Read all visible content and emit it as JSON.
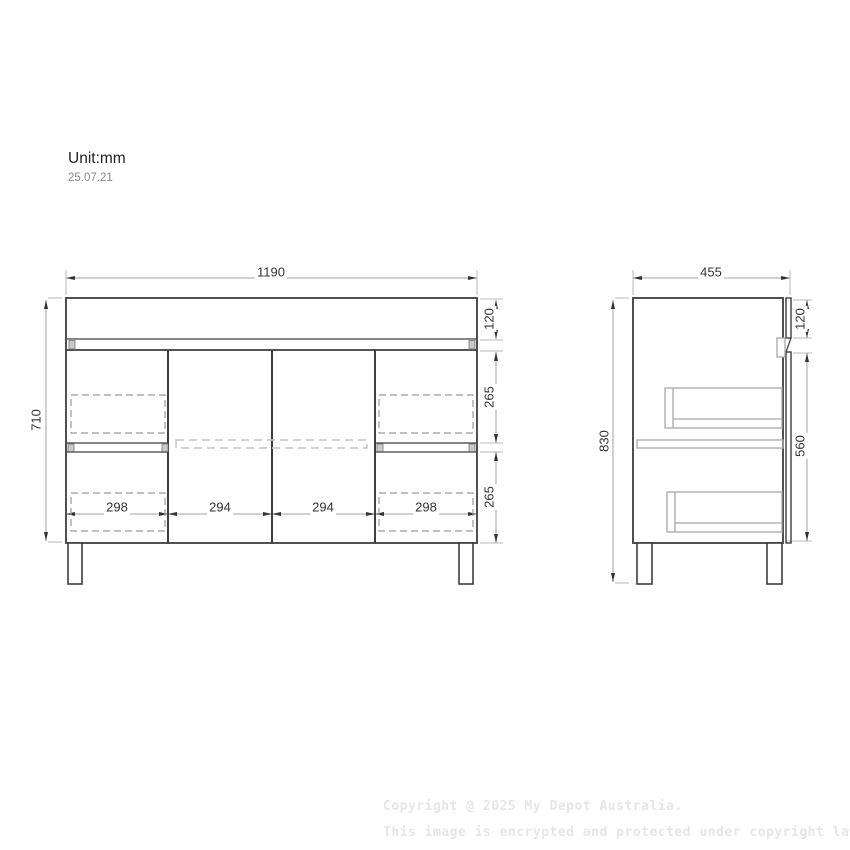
{
  "header": {
    "unit_label": "Unit:mm",
    "date": "25.07.21"
  },
  "front_view": {
    "name": "vanity-cabinet-front-elevation",
    "dims": {
      "overall_width": "1190",
      "overall_height": "710",
      "benchtop_height": "120",
      "upper_drawer_height": "265",
      "lower_drawer_height": "265",
      "left_drawer_width": "298",
      "left_door_width": "294",
      "right_door_width": "294",
      "right_drawer_width": "298"
    }
  },
  "side_view": {
    "name": "vanity-cabinet-side-elevation",
    "dims": {
      "overall_depth": "455",
      "overall_height": "830",
      "benchtop_height": "120",
      "carcass_height": "560"
    }
  },
  "watermark": {
    "line1": "Copyright @ 2025 My Depot Australia.",
    "line2": "This image is encrypted and protected under copyright law."
  },
  "colors": {
    "outline": "#3d3d3d",
    "dim_line": "#a3a3a3",
    "ext_line": "#b8b8b8",
    "dim_text": "#333333",
    "hidden_line": "#9a9a9a",
    "light_dash": "#c4c4c4",
    "internal_gray": "#a8a8a8",
    "cap_fill": "#c9c9c9",
    "watermark": "#e6e6e6"
  }
}
